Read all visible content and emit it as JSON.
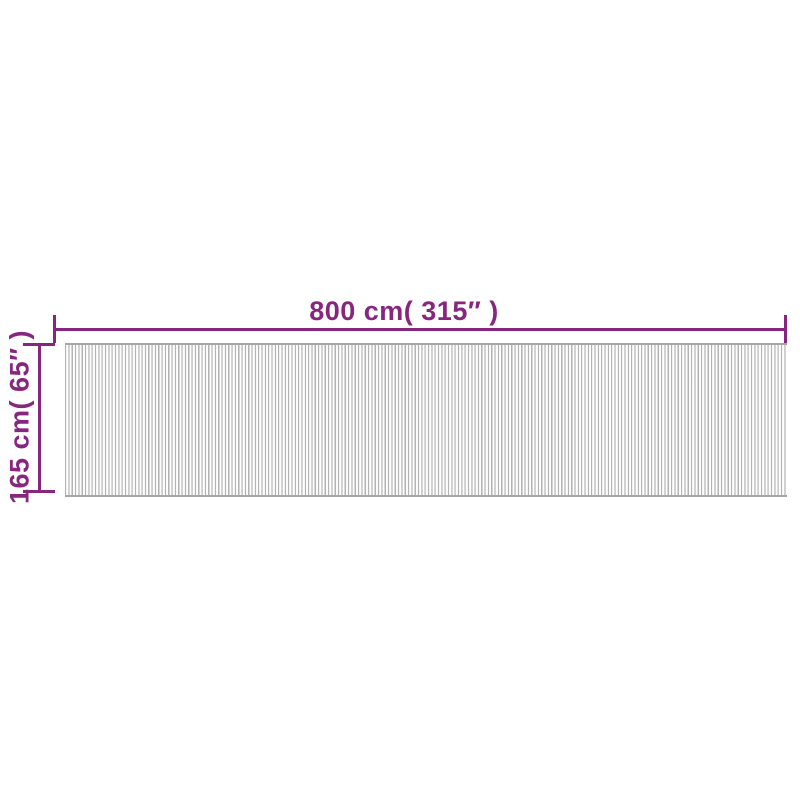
{
  "diagram": {
    "width_label": "800 cm( 315″ )",
    "height_label": "165 cm( 65″ )",
    "accent_color": "#87267f",
    "mat_colors": {
      "stripe_gray": "#b3b3b3",
      "stripe_mid": "#e8e8e8",
      "stripe_light": "#ffffff",
      "edge_gray": "#a6a6a6"
    }
  }
}
